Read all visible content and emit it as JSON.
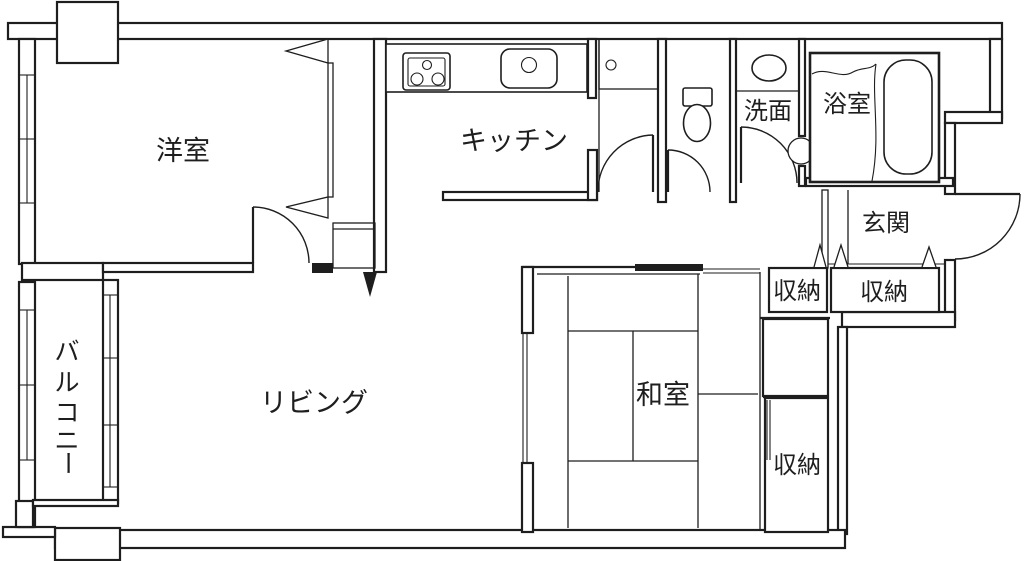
{
  "floorplan": {
    "background": "#ffffff",
    "line_color": "#1e1e1e",
    "rooms": {
      "western": {
        "label": "洋室"
      },
      "kitchen": {
        "label": "キッチン"
      },
      "washroom": {
        "label": "洗面"
      },
      "bathroom": {
        "label": "浴室"
      },
      "entrance": {
        "label": "玄関"
      },
      "living": {
        "label": "リビング"
      },
      "japanese": {
        "label": "和室"
      },
      "storage_hall_left": {
        "label": "収納"
      },
      "storage_hall_right": {
        "label": "収納"
      },
      "storage_japanese": {
        "label": "収納"
      },
      "balcony": {
        "label": "バルコニー",
        "chars": [
          "バ",
          "ル",
          "コ",
          "ニ",
          "ー"
        ]
      }
    },
    "fixtures": {
      "stove": "gas-stove-3-burner",
      "kitchen_sink": "kitchen-sink",
      "utility_point": "utility-water-point",
      "toilet": "toilet",
      "wash_basin": "wash-basin",
      "bathtub": "bathtub",
      "bath_door": "bath-door-symbol",
      "closet_doors": "bifold-closet-door-marks"
    }
  }
}
